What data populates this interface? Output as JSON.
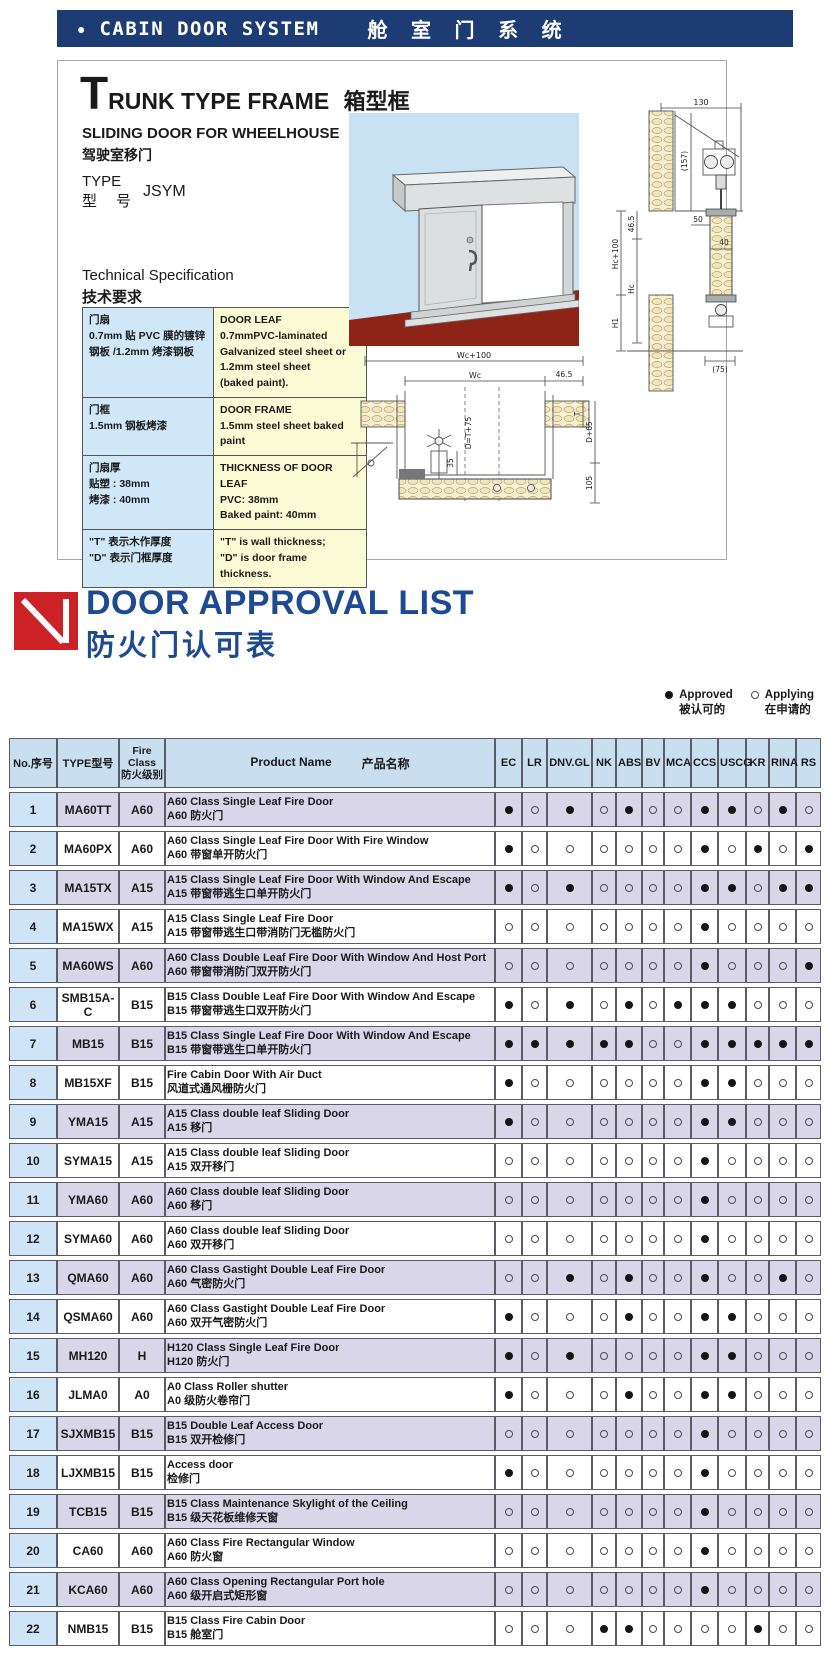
{
  "banner": {
    "bullet": "●",
    "title_en": "CABIN DOOR SYSTEM",
    "title_cn": "舱 室 门 系 统"
  },
  "trunk": {
    "title_initial": "T",
    "title_rest": "RUNK TYPE FRAME",
    "title_cn": "箱型框",
    "subtitle_en": "SLIDING DOOR FOR WHEELHOUSE",
    "subtitle_cn": "驾驶室移门",
    "type_label_en": "TYPE",
    "type_label_cn": "型　号",
    "type_value": "JSYM",
    "spec_heading_en": "Technical Specification",
    "spec_heading_cn": "技术要求",
    "spec_rows": [
      {
        "cn": [
          "门扇",
          "0.7mm 贴 PVC 膜的镀锌",
          "钢板 /1.2mm 烤漆钢板"
        ],
        "en": [
          "DOOR LEAF",
          "0.7mmPVC-laminated",
          "Galvanized steel sheet or",
          "1.2mm steel sheet",
          "(baked paint)."
        ]
      },
      {
        "cn": [
          "门框",
          "1.5mm 钢板烤漆"
        ],
        "en": [
          "DOOR FRAME",
          "1.5mm steel sheet baked paint"
        ]
      },
      {
        "cn": [
          "门扇厚",
          "贴塑 : 38mm",
          "烤漆 : 40mm"
        ],
        "en": [
          "THICKNESS OF DOOR LEAF",
          "PVC: 38mm",
          "Baked paint: 40mm"
        ]
      },
      {
        "cn": [
          "\"T\" 表示木作厚度",
          "\"D\" 表示门框厚度"
        ],
        "en": [
          "\"T\" is wall thickness;",
          "\"D\" is door frame thickness."
        ]
      }
    ],
    "dims_v": [
      "130",
      "(157)",
      "46.5",
      "Hc+100",
      "Hc",
      "50",
      "40",
      "H1",
      "(75)"
    ],
    "dims_h": [
      "Wc+100",
      "Wc",
      "46.5",
      "D=T+75",
      "35",
      "T",
      "D+65",
      "105"
    ]
  },
  "approval": {
    "title": "DOOR APPROVAL LIST",
    "subtitle": "防火门认可表",
    "legend": {
      "approved_en": "Approved",
      "approved_cn": "被认可的",
      "applying_en": "Applying",
      "applying_cn": "在申请的"
    },
    "header": {
      "no": "No.序号",
      "type": "TYPE型号",
      "fire": [
        "Fire",
        "Class",
        "防火级别"
      ],
      "product_en": "Product Name",
      "product_cn": "产品名称"
    },
    "societies": [
      "EC",
      "LR",
      "DNV.GL",
      "NK",
      "ABS",
      "BV",
      "MCA",
      "CCS",
      "USCG",
      "KR",
      "RINA",
      "RS"
    ],
    "rows": [
      {
        "no": "1",
        "type": "MA60TT",
        "fire": "A60",
        "name_en": "A60 Class Single Leaf Fire Door",
        "name_cn": "A60 防火门",
        "marks": [
          1,
          0,
          1,
          0,
          1,
          0,
          0,
          1,
          1,
          0,
          1,
          0
        ]
      },
      {
        "no": "2",
        "type": "MA60PX",
        "fire": "A60",
        "name_en": "A60 Class Single Leaf Fire Door With Fire Window",
        "name_cn": "A60 带窗单开防火门",
        "marks": [
          1,
          0,
          0,
          0,
          0,
          0,
          0,
          1,
          0,
          1,
          0,
          1
        ]
      },
      {
        "no": "3",
        "type": "MA15TX",
        "fire": "A15",
        "name_en": "A15 Class Single Leaf Fire Door With Window And Escape",
        "name_cn": "A15 带窗带逃生口单开防火门",
        "marks": [
          1,
          0,
          1,
          0,
          0,
          0,
          0,
          1,
          1,
          0,
          1,
          1
        ]
      },
      {
        "no": "4",
        "type": "MA15WX",
        "fire": "A15",
        "name_en": "A15 Class Single Leaf Fire Door",
        "name_cn": "A15 带窗带逃生口带消防门无槛防火门",
        "marks": [
          0,
          0,
          0,
          0,
          0,
          0,
          0,
          1,
          0,
          0,
          0,
          0
        ]
      },
      {
        "no": "5",
        "type": "MA60WS",
        "fire": "A60",
        "name_en": "A60 Class Double Leaf Fire Door With Window And Host Port",
        "name_cn": "A60 带窗带消防门双开防火门",
        "marks": [
          0,
          0,
          0,
          0,
          0,
          0,
          0,
          1,
          0,
          0,
          0,
          1
        ]
      },
      {
        "no": "6",
        "type": "SMB15A-C",
        "fire": "B15",
        "name_en": "B15 Class Double Leaf Fire Door With Window And Escape",
        "name_cn": "B15 带窗带逃生口双开防火门",
        "marks": [
          1,
          0,
          1,
          0,
          1,
          0,
          1,
          1,
          1,
          0,
          0,
          0
        ]
      },
      {
        "no": "7",
        "type": "MB15",
        "fire": "B15",
        "name_en": "B15 Class Single Leaf Fire Door With Window And Escape",
        "name_cn": "B15 带窗带逃生口单开防火门",
        "marks": [
          1,
          1,
          1,
          1,
          1,
          0,
          0,
          1,
          1,
          1,
          1,
          1
        ]
      },
      {
        "no": "8",
        "type": "MB15XF",
        "fire": "B15",
        "name_en": "Fire Cabin Door With Air Duct",
        "name_cn": "风道式通风栅防火门",
        "marks": [
          1,
          0,
          0,
          0,
          0,
          0,
          0,
          1,
          1,
          0,
          0,
          0
        ]
      },
      {
        "no": "9",
        "type": "YMA15",
        "fire": "A15",
        "name_en": "A15 Class double leaf Sliding Door",
        "name_cn": "A15 移门",
        "marks": [
          1,
          0,
          0,
          0,
          0,
          0,
          0,
          1,
          1,
          0,
          0,
          0
        ]
      },
      {
        "no": "10",
        "type": "SYMA15",
        "fire": "A15",
        "name_en": "A15 Class double leaf Sliding Door",
        "name_cn": "A15 双开移门",
        "marks": [
          0,
          0,
          0,
          0,
          0,
          0,
          0,
          1,
          0,
          0,
          0,
          0
        ]
      },
      {
        "no": "11",
        "type": "YMA60",
        "fire": "A60",
        "name_en": "A60 Class double leaf Sliding Door",
        "name_cn": "A60 移门",
        "marks": [
          0,
          0,
          0,
          0,
          0,
          0,
          0,
          1,
          0,
          0,
          0,
          0
        ]
      },
      {
        "no": "12",
        "type": "SYMA60",
        "fire": "A60",
        "name_en": "A60 Class double leaf Sliding Door",
        "name_cn": "A60 双开移门",
        "marks": [
          0,
          0,
          0,
          0,
          0,
          0,
          0,
          1,
          0,
          0,
          0,
          0
        ]
      },
      {
        "no": "13",
        "type": "QMA60",
        "fire": "A60",
        "name_en": "A60 Class Gastight Double Leaf Fire Door",
        "name_cn": "A60 气密防火门",
        "marks": [
          0,
          0,
          1,
          0,
          1,
          0,
          0,
          1,
          0,
          0,
          1,
          0
        ]
      },
      {
        "no": "14",
        "type": "QSMA60",
        "fire": "A60",
        "name_en": "A60 Class Gastight Double Leaf Fire Door",
        "name_cn": "A60 双开气密防火门",
        "marks": [
          1,
          0,
          0,
          0,
          1,
          0,
          0,
          1,
          1,
          0,
          0,
          0
        ]
      },
      {
        "no": "15",
        "type": "MH120",
        "fire": "H",
        "name_en": "H120 Class Single Leaf Fire Door",
        "name_cn": "H120 防火门",
        "marks": [
          1,
          0,
          1,
          0,
          0,
          0,
          0,
          1,
          1,
          0,
          0,
          0
        ]
      },
      {
        "no": "16",
        "type": "JLMA0",
        "fire": "A0",
        "name_en": "A0 Class Roller shutter",
        "name_cn": "A0 级防火卷帘门",
        "marks": [
          1,
          0,
          0,
          0,
          1,
          0,
          0,
          1,
          1,
          0,
          0,
          0
        ]
      },
      {
        "no": "17",
        "type": "SJXMB15",
        "fire": "B15",
        "name_en": "B15  Double Leaf Access Door",
        "name_cn": "B15 双开检修门",
        "marks": [
          0,
          0,
          0,
          0,
          0,
          0,
          0,
          1,
          0,
          0,
          0,
          0
        ]
      },
      {
        "no": "18",
        "type": "LJXMB15",
        "fire": "B15",
        "name_en": "Access door",
        "name_cn": "检修门",
        "marks": [
          1,
          0,
          0,
          0,
          0,
          0,
          0,
          1,
          0,
          0,
          0,
          0
        ]
      },
      {
        "no": "19",
        "type": "TCB15",
        "fire": "B15",
        "name_en": "B15 Class Maintenance Skylight of the Ceiling",
        "name_cn": "B15 级天花板维修天窗",
        "marks": [
          0,
          0,
          0,
          0,
          0,
          0,
          0,
          1,
          0,
          0,
          0,
          0
        ]
      },
      {
        "no": "20",
        "type": "CA60",
        "fire": "A60",
        "name_en": "A60 Class Fire Rectangular Window",
        "name_cn": "A60 防火窗",
        "marks": [
          0,
          0,
          0,
          0,
          0,
          0,
          0,
          1,
          0,
          0,
          0,
          0
        ]
      },
      {
        "no": "21",
        "type": "KCA60",
        "fire": "A60",
        "name_en": "A60 Class  Opening Rectangular Port hole",
        "name_cn": "A60 级开启式矩形窗",
        "marks": [
          0,
          0,
          0,
          0,
          0,
          0,
          0,
          1,
          0,
          0,
          0,
          0
        ]
      },
      {
        "no": "22",
        "type": "NMB15",
        "fire": "B15",
        "name_en": "B15 Class Fire Cabin Door",
        "name_cn": "B15 舱室门",
        "marks": [
          0,
          0,
          0,
          1,
          1,
          0,
          0,
          0,
          0,
          1,
          0,
          0
        ]
      }
    ]
  },
  "colors": {
    "banner_bg": "#1e3c74",
    "heading_blue": "#1d4a91",
    "logo_red": "#cc2127",
    "table_header_bg": "#c9dff0",
    "row_alt_bg": "#d9d6e9",
    "no_col_bg": "#cfe4f6",
    "spec_cn_bg": "#cfe7f7",
    "spec_en_bg": "#fafbd4",
    "approved_dot": "#151515",
    "sky_blue": "#c8e1f3",
    "floor_red": "#8e2318"
  }
}
